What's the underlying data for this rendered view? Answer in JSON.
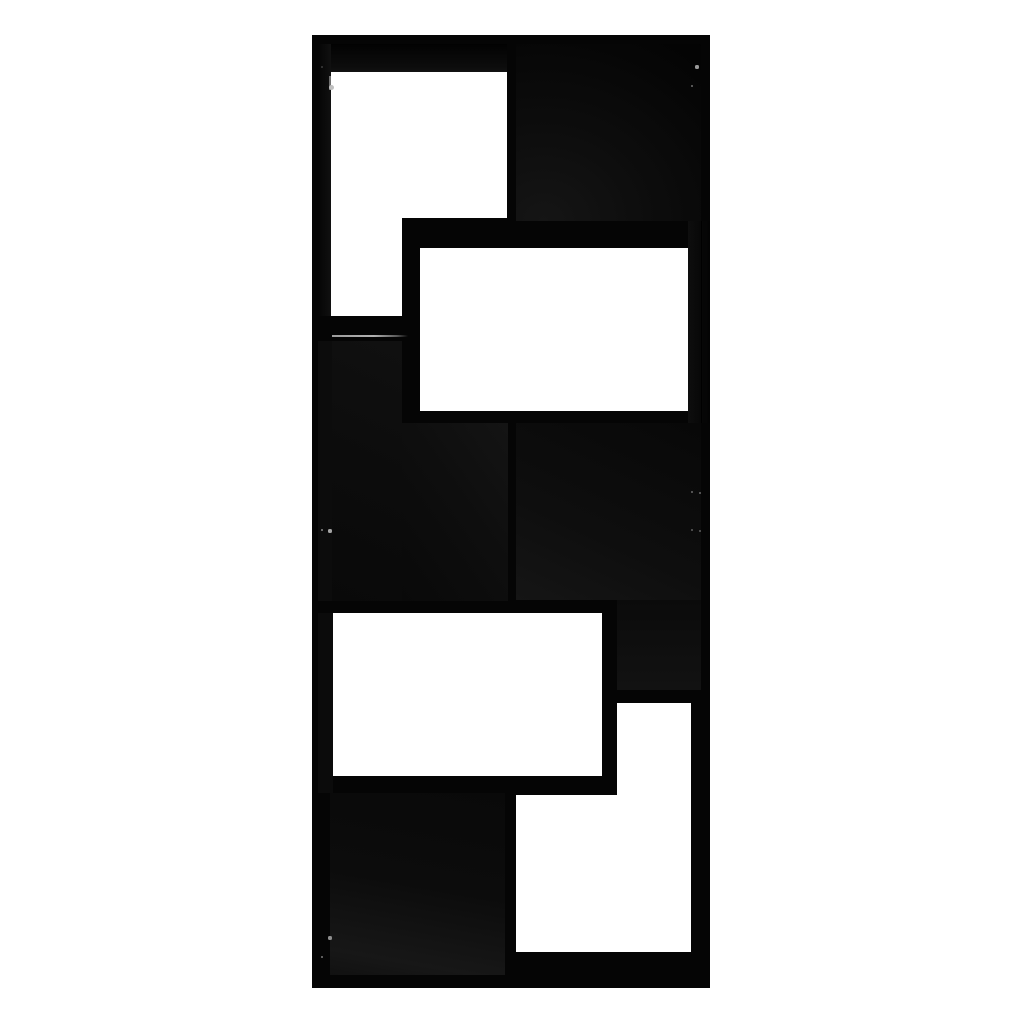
{
  "scene": {
    "type": "product-photo",
    "subject": "black geometric cube bookshelf room divider, front view",
    "background_color": "#ffffff",
    "furniture_color": "#060606",
    "open_compartments": 4,
    "shadowed_compartments": 4
  },
  "canvas": {
    "width": 1024,
    "height": 1024
  },
  "unit": {
    "name": "bookshelf-body",
    "x": 312,
    "y": 35,
    "w": 398,
    "h": 953,
    "fill": "#050505"
  },
  "panels": [
    {
      "name": "top-board-underside",
      "x": 331,
      "y": 44,
      "w": 176,
      "h": 28,
      "fill": "linear-gradient(180deg,#020202 0%,#0d0d0d 85%,#121212 100%)"
    },
    {
      "name": "left-wall-inner-face-top",
      "x": 318,
      "y": 44,
      "w": 13,
      "h": 272,
      "fill": "linear-gradient(90deg,#050505,#101010)"
    },
    {
      "name": "compartment-top-right-interior",
      "x": 516,
      "y": 44,
      "w": 185,
      "h": 177,
      "fill": "radial-gradient(140% 130% at 15% 100%, #151515 0%, #0d0d0d 40%, #060606 80%, #030303 100%)"
    },
    {
      "name": "box-right-wall-face",
      "x": 688,
      "y": 221,
      "w": 22,
      "h": 202,
      "fill": "linear-gradient(90deg,#0e0e0e 0%,#080808 55%,#040404 100%)"
    },
    {
      "name": "compartment-mid-left-interior-a",
      "x": 332,
      "y": 341,
      "w": 70,
      "h": 260,
      "fill": "linear-gradient(205deg,#101010 0%,#0c0c0c 50%,#090909 100%)"
    },
    {
      "name": "compartment-mid-left-interior-b",
      "x": 402,
      "y": 423,
      "w": 106,
      "h": 178,
      "fill": "linear-gradient(235deg,#141414 0%,#0e0e0e 45%,#090909 100%)"
    },
    {
      "name": "left-wall-inner-face-mid",
      "x": 318,
      "y": 341,
      "w": 14,
      "h": 260,
      "fill": "#0c0c0c"
    },
    {
      "name": "compartment-mid-right-interior",
      "x": 516,
      "y": 423,
      "w": 185,
      "h": 177,
      "fill": "linear-gradient(25deg,#151515 0%,#0e0e0e 40%,#080808 100%)"
    },
    {
      "name": "compartment-mid-right-lower",
      "x": 617,
      "y": 600,
      "w": 84,
      "h": 90,
      "fill": "linear-gradient(180deg,#0b0b0b,#121212)"
    },
    {
      "name": "left-wall-inner-face-lower",
      "x": 318,
      "y": 613,
      "w": 15,
      "h": 180,
      "fill": "#0b0b0b"
    },
    {
      "name": "compartment-bottom-left-interior",
      "x": 330,
      "y": 793,
      "w": 175,
      "h": 182,
      "fill": "linear-gradient(190deg,#090909 0%,#0c0c0c 50%,#171717 88%,#111111 100%)"
    }
  ],
  "cutouts": [
    {
      "name": "opening-top-left-main",
      "x": 331,
      "y": 72,
      "w": 176,
      "h": 146
    },
    {
      "name": "opening-top-left-tail",
      "x": 331,
      "y": 218,
      "w": 71,
      "h": 98
    },
    {
      "name": "opening-protruding-box",
      "x": 420,
      "y": 248,
      "w": 268,
      "h": 163
    },
    {
      "name": "opening-lower-middle",
      "x": 333,
      "y": 613,
      "w": 269,
      "h": 163
    },
    {
      "name": "opening-bottom-right-upper",
      "x": 617,
      "y": 703,
      "w": 74,
      "h": 92
    },
    {
      "name": "opening-bottom-right-lower",
      "x": 516,
      "y": 795,
      "w": 175,
      "h": 157
    }
  ],
  "highlights": [
    {
      "name": "shelf-edge-highlight",
      "x": 332,
      "y": 335,
      "w": 76,
      "h": 2,
      "fill": "linear-gradient(90deg,#9c9c9c 0%,#b2b2b2 55%,#5a5a5a 85%,rgba(40,40,40,0) 100%)"
    },
    {
      "name": "left-edge-highlight",
      "x": 329,
      "y": 76,
      "w": 2,
      "h": 14,
      "fill": "#6f6f6f"
    },
    {
      "name": "box-wall-seam",
      "x": 701,
      "y": 221,
      "w": 1,
      "h": 202,
      "fill": "#000000"
    }
  ],
  "cam_hole_dots": [
    {
      "x": 697,
      "y": 67,
      "r": 1.6,
      "color": "#9a9a9a"
    },
    {
      "x": 692,
      "y": 86,
      "r": 1.4,
      "color": "#6f6f6f"
    },
    {
      "x": 331,
      "y": 87,
      "r": 2.5,
      "color": "#c0c0c0"
    },
    {
      "x": 322,
      "y": 67,
      "r": 1.2,
      "color": "#3d3d3d"
    },
    {
      "x": 692,
      "y": 492,
      "r": 1.3,
      "color": "#6a6a6a"
    },
    {
      "x": 700,
      "y": 493,
      "r": 1.3,
      "color": "#6a6a6a"
    },
    {
      "x": 692,
      "y": 530,
      "r": 1.3,
      "color": "#606060"
    },
    {
      "x": 700,
      "y": 531,
      "r": 1.3,
      "color": "#606060"
    },
    {
      "x": 322,
      "y": 530,
      "r": 1.4,
      "color": "#8a8a8a"
    },
    {
      "x": 330,
      "y": 531,
      "r": 1.6,
      "color": "#a5a5a5"
    },
    {
      "x": 330,
      "y": 938,
      "r": 1.6,
      "color": "#8f8f8f"
    },
    {
      "x": 322,
      "y": 957,
      "r": 1.4,
      "color": "#7a7a7a"
    }
  ]
}
